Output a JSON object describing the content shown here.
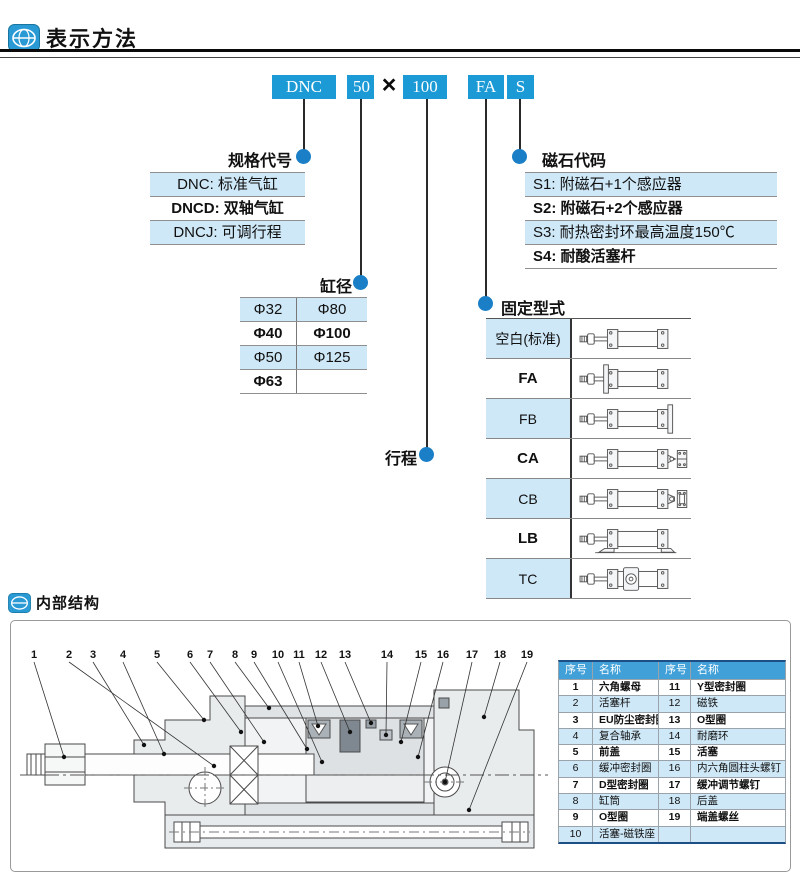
{
  "colors": {
    "primary_blue": "#1b9ad6",
    "bullet_blue": "#1a7fc6",
    "row_blue": "#cfe8f7",
    "table_header_blue": "#42a0d8"
  },
  "sections": {
    "method_title": "表示方法",
    "structure_title": "内部结构"
  },
  "model_code": {
    "boxes": [
      "DNC",
      "50",
      "100",
      "FA",
      "S"
    ],
    "separator": "×"
  },
  "spec_code": {
    "label": "规格代号",
    "rows": [
      "DNC: 标准气缸",
      "DNCD: 双轴气缸",
      "DNCJ: 可调行程"
    ]
  },
  "magnet_code": {
    "label": "磁石代码",
    "rows": [
      "S1: 附磁石+1个感应器",
      "S2: 附磁石+2个感应器",
      "S3: 耐热密封环最高温度150℃",
      "S4: 耐酸活塞杆"
    ]
  },
  "bore": {
    "label": "缸径",
    "rows": [
      [
        "Φ32",
        "Φ80"
      ],
      [
        "Φ40",
        "Φ100"
      ],
      [
        "Φ50",
        "Φ125"
      ],
      [
        "Φ63",
        ""
      ]
    ]
  },
  "stroke": {
    "label": "行程"
  },
  "mounting": {
    "label": "固定型式",
    "rows": [
      "空白(标准)",
      "FA",
      "FB",
      "CA",
      "CB",
      "LB",
      "TC"
    ]
  },
  "parts_table": {
    "headers": [
      "序号",
      "名称",
      "序号",
      "名称"
    ],
    "rows": [
      [
        "1",
        "六角螺母",
        "11",
        "Y型密封圈"
      ],
      [
        "2",
        "活塞杆",
        "12",
        "磁铁"
      ],
      [
        "3",
        "EU防尘密封圈",
        "13",
        "O型圈"
      ],
      [
        "4",
        "复合轴承",
        "14",
        "耐磨环"
      ],
      [
        "5",
        "前盖",
        "15",
        "活塞"
      ],
      [
        "6",
        "缓冲密封圈",
        "16",
        "内六角圆柱头螺钉"
      ],
      [
        "7",
        "D型密封圈",
        "17",
        "缓冲调节螺钉"
      ],
      [
        "8",
        "缸筒",
        "18",
        "后盖"
      ],
      [
        "9",
        "O型圈",
        "19",
        "端盖螺丝"
      ],
      [
        "10",
        "活塞-磁铁座",
        "",
        ""
      ]
    ]
  },
  "diagram": {
    "callouts": [
      {
        "n": "1",
        "x": 20,
        "tx": 50,
        "ty": 115
      },
      {
        "n": "2",
        "x": 55,
        "tx": 200,
        "ty": 124
      },
      {
        "n": "3",
        "x": 79,
        "tx": 130,
        "ty": 103
      },
      {
        "n": "4",
        "x": 109,
        "tx": 150,
        "ty": 112
      },
      {
        "n": "5",
        "x": 143,
        "tx": 190,
        "ty": 78
      },
      {
        "n": "6",
        "x": 176,
        "tx": 227,
        "ty": 90
      },
      {
        "n": "7",
        "x": 196,
        "tx": 250,
        "ty": 100
      },
      {
        "n": "8",
        "x": 221,
        "tx": 255,
        "ty": 66
      },
      {
        "n": "9",
        "x": 240,
        "tx": 293,
        "ty": 107
      },
      {
        "n": "10",
        "x": 264,
        "tx": 308,
        "ty": 120
      },
      {
        "n": "11",
        "x": 285,
        "tx": 304,
        "ty": 84
      },
      {
        "n": "12",
        "x": 307,
        "tx": 336,
        "ty": 90
      },
      {
        "n": "13",
        "x": 331,
        "tx": 357,
        "ty": 81
      },
      {
        "n": "14",
        "x": 373,
        "tx": 372,
        "ty": 93
      },
      {
        "n": "15",
        "x": 407,
        "tx": 387,
        "ty": 100
      },
      {
        "n": "16",
        "x": 429,
        "tx": 404,
        "ty": 115
      },
      {
        "n": "17",
        "x": 458,
        "tx": 431,
        "ty": 140
      },
      {
        "n": "18",
        "x": 486,
        "tx": 470,
        "ty": 75
      },
      {
        "n": "19",
        "x": 513,
        "tx": 455,
        "ty": 168
      }
    ]
  }
}
